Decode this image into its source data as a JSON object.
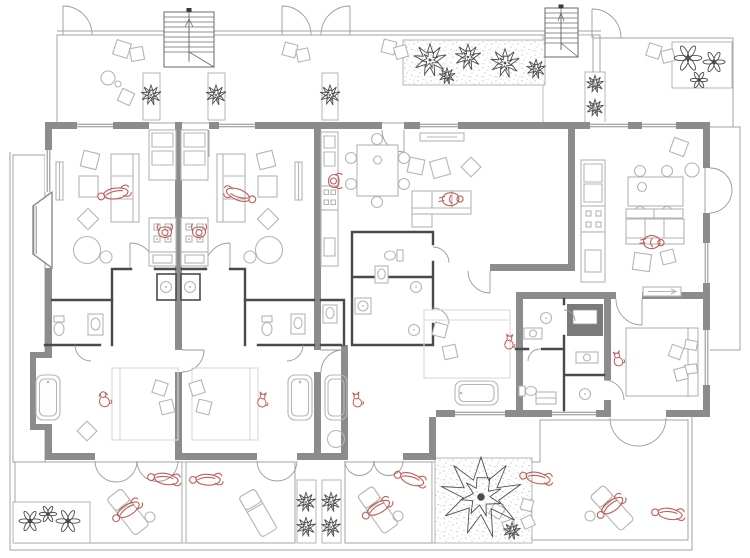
{
  "meta": {
    "alt": "architectural floor plan of a multi-unit apartment building with terraces"
  },
  "colors": {
    "paper": "#ffffff",
    "wall": "#8c8c8c",
    "wallDark": "#4a4a4a",
    "outline": "#a3a3a3",
    "furniture": "#b5b5b5",
    "furnitureFaint": "#d9d9d9",
    "hatch": "#cfcfcf",
    "stipple": "#8a8a8a",
    "plant": "#4d4d4d",
    "figure": "#c05e58"
  },
  "scene": {
    "figures": [
      {
        "type": "person-lying",
        "x": 114,
        "y": 194,
        "rot": -15
      },
      {
        "type": "person-lying",
        "x": 240,
        "y": 195,
        "rot": 195
      },
      {
        "type": "person-standing",
        "x": 165,
        "y": 232,
        "rot": 180
      },
      {
        "type": "person-standing",
        "x": 199,
        "y": 232,
        "rot": 180
      },
      {
        "type": "person-standing",
        "x": 334,
        "y": 181,
        "rot": -90
      },
      {
        "type": "person-sitting",
        "x": 452,
        "y": 199,
        "rot": 90
      },
      {
        "type": "person-sitting",
        "x": 653,
        "y": 242,
        "rot": 95
      },
      {
        "type": "dog",
        "x": 104,
        "y": 400,
        "rot": -10
      },
      {
        "type": "cat",
        "x": 262,
        "y": 401,
        "rot": 8
      },
      {
        "type": "cat",
        "x": 357,
        "y": 401,
        "rot": -8
      },
      {
        "type": "cat",
        "x": 509,
        "y": 343,
        "rot": 5
      },
      {
        "type": "cat",
        "x": 618,
        "y": 360,
        "rot": -12
      },
      {
        "type": "person-lying",
        "x": 164,
        "y": 479,
        "rot": 4
      },
      {
        "type": "person-lying",
        "x": 206,
        "y": 480,
        "rot": -4
      },
      {
        "type": "person-lying",
        "x": 410,
        "y": 479,
        "rot": 14
      },
      {
        "type": "person-lying",
        "x": 536,
        "y": 478,
        "rot": 6
      },
      {
        "type": "person-lying",
        "x": 668,
        "y": 514,
        "rot": 3
      },
      {
        "type": "person-lying",
        "x": 127,
        "y": 511,
        "rot": -38
      },
      {
        "type": "person-lying",
        "x": 377,
        "y": 509,
        "rot": -35
      },
      {
        "type": "person-lying",
        "x": 611,
        "y": 507,
        "rot": -42
      }
    ],
    "plants": [
      {
        "kind": "tree",
        "x": 430,
        "y": 60,
        "s": 1.7
      },
      {
        "kind": "tree",
        "x": 468,
        "y": 57,
        "s": 1.35
      },
      {
        "kind": "tree",
        "x": 505,
        "y": 63,
        "s": 1.5
      },
      {
        "kind": "tree",
        "x": 536,
        "y": 69,
        "s": 1.0
      },
      {
        "kind": "tree",
        "x": 447,
        "y": 76,
        "s": 0.85
      },
      {
        "kind": "tree",
        "x": 151,
        "y": 95,
        "s": 1.05
      },
      {
        "kind": "tree",
        "x": 216,
        "y": 95,
        "s": 1.05
      },
      {
        "kind": "tree",
        "x": 330,
        "y": 95,
        "s": 1.05
      },
      {
        "kind": "tree",
        "x": 595,
        "y": 84,
        "s": 0.9
      },
      {
        "kind": "tree",
        "x": 595,
        "y": 108,
        "s": 0.9
      },
      {
        "kind": "flower",
        "x": 688,
        "y": 58,
        "s": 1.5
      },
      {
        "kind": "flower",
        "x": 714,
        "y": 62,
        "s": 1.2
      },
      {
        "kind": "flower",
        "x": 699,
        "y": 80,
        "s": 0.95
      },
      {
        "kind": "tree",
        "x": 306,
        "y": 502,
        "s": 1.0
      },
      {
        "kind": "tree",
        "x": 306,
        "y": 527,
        "s": 1.0
      },
      {
        "kind": "tree",
        "x": 331,
        "y": 502,
        "s": 1.0
      },
      {
        "kind": "tree",
        "x": 331,
        "y": 527,
        "s": 1.0
      },
      {
        "kind": "flower",
        "x": 30,
        "y": 521,
        "s": 1.2
      },
      {
        "kind": "flower",
        "x": 48,
        "y": 514,
        "s": 0.95
      },
      {
        "kind": "flower",
        "x": 68,
        "y": 521,
        "s": 1.3
      },
      {
        "kind": "tree",
        "x": 481,
        "y": 497,
        "s": 4.2
      },
      {
        "kind": "tree",
        "x": 512,
        "y": 531,
        "s": 0.9
      }
    ]
  }
}
